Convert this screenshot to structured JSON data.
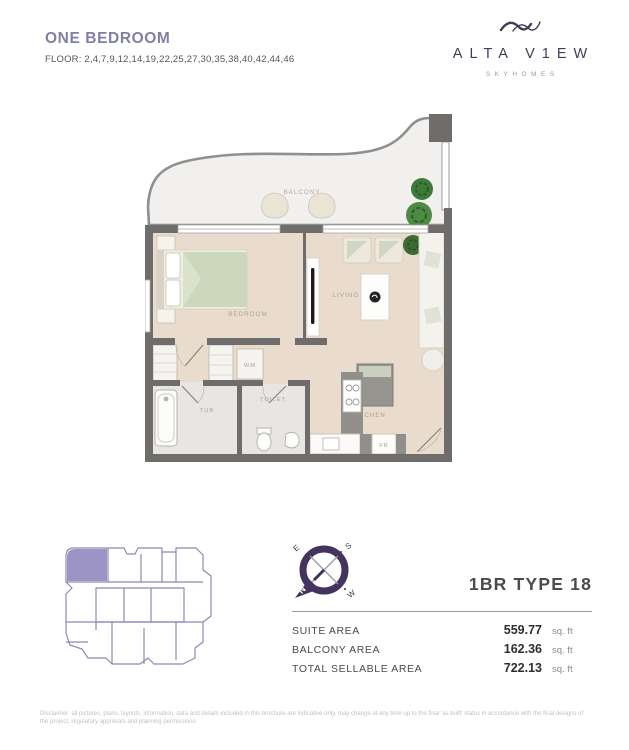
{
  "header": {
    "title": "ONE BEDROOM",
    "floors": "FLOOR: 2,4,7,9,12,14,19,22,25,27,30,35,38,40,42,44,46",
    "brand": {
      "name": "ALTA V1EW",
      "tagline": "SKYHOMES"
    }
  },
  "floorplan": {
    "rooms": {
      "balcony": "BALCONY",
      "bedroom": "BEDROOM",
      "living": "LIVING",
      "wm": "WM",
      "tub": "TUB",
      "toilet": "TOILET",
      "kitchen": "KITCHEN",
      "fr": "FR"
    }
  },
  "compass": {
    "n": "N",
    "e": "E",
    "s": "S",
    "w": "W"
  },
  "unit": {
    "type_label": "1BR TYPE 18",
    "areas": [
      {
        "label": "SUITE AREA",
        "value": "559.77",
        "unit": "sq. ft"
      },
      {
        "label": "BALCONY AREA",
        "value": "162.36",
        "unit": "sq. ft"
      },
      {
        "label": "TOTAL SELLABLE AREA",
        "value": "722.13",
        "unit": "sq. ft"
      }
    ]
  },
  "disclaimer": "Disclaimer: all pictures, plans, layouts, information, data and details included in this brochure are indicative only, may change at any time up to the final 'as built' status in accordance with the final designs of the project, regulatory approvals and planning permissions.",
  "colors": {
    "accent_purple": "#807FA6",
    "brand_navy": "#3e3e58",
    "wall_gray": "#6e6d6b",
    "wood_floor": "#e9dccd",
    "bath_floor": "#e7e6e4",
    "keyplan_line": "#8d89b8",
    "keyplan_highlight": "#9c94c4",
    "compass_purple": "#44335f",
    "plant_green": "#3e6b34",
    "bed_green": "#cbd8bc"
  }
}
